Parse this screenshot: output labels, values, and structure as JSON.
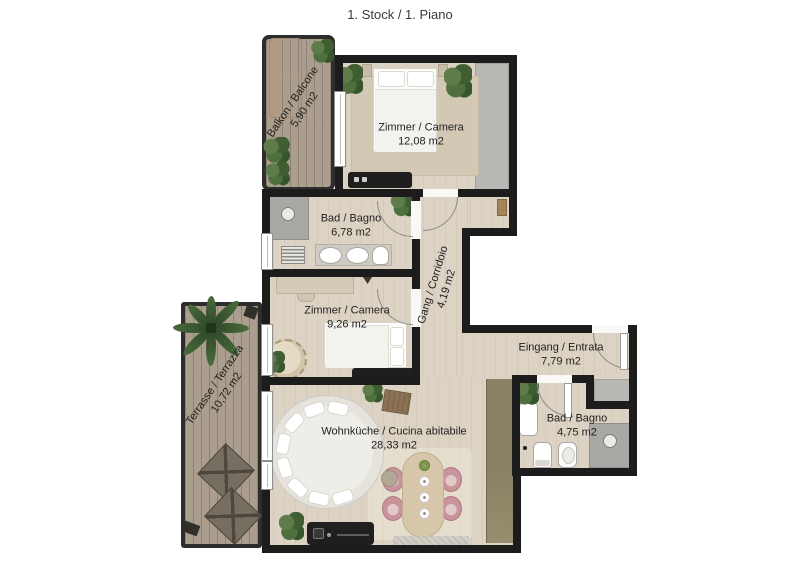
{
  "title": "1. Stock / 1. Piano",
  "rooms": {
    "balcony": {
      "label": "Balkon / Balcone",
      "area": "5,90 m2"
    },
    "bedroom_large": {
      "label": "Zimmer / Camera",
      "area": "12,08 m2"
    },
    "bathroom_large": {
      "label": "Bad / Bagno",
      "area": "6,78 m2"
    },
    "corridor": {
      "label": "Gang / Corridoio",
      "area": "4,19 m2"
    },
    "bedroom_small": {
      "label": "Zimmer / Camera",
      "area": "9,26 m2"
    },
    "terrace": {
      "label": "Terrasse / Terrazza",
      "area": "10,72 m2"
    },
    "entrance": {
      "label": "Eingang / Entrata",
      "area": "7,79 m2"
    },
    "bathroom_small": {
      "label": "Bad / Bagno",
      "area": "4,75 m2"
    },
    "living_kitchen": {
      "label": "Wohnküche / Cucina abitabile",
      "area": "28,33 m2"
    }
  },
  "colors": {
    "wall": "#1c1c1c",
    "floor": "#ddd3c4",
    "decking": "#ac9e8f",
    "closet_gray": "#b9b7b3",
    "cabinet_olive": "#8a8164",
    "chair_pink": "#c9939b",
    "plant_green": "#47663a",
    "text": "#1f1f1f"
  }
}
